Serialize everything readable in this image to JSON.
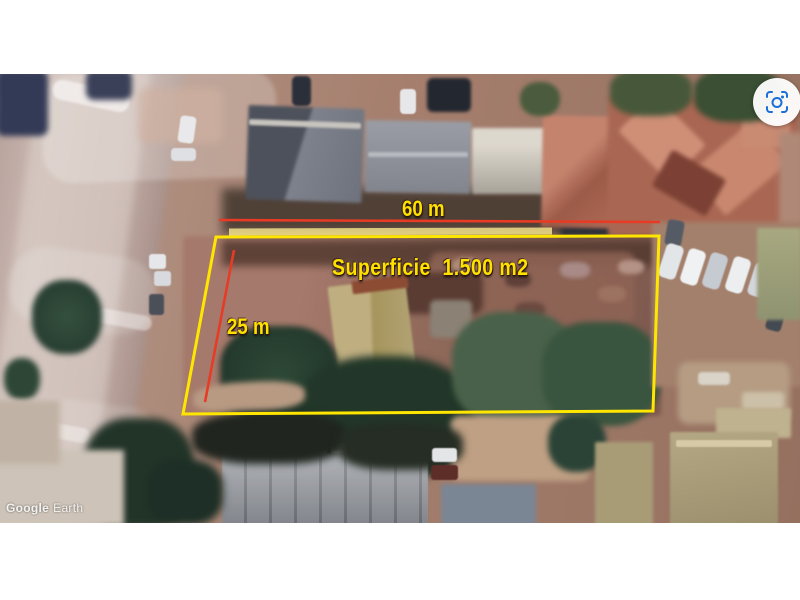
{
  "annotations": {
    "width_label": "60 m",
    "depth_label": "25 m",
    "area_label": "Superficie  1.500 m2",
    "measurement_line_color": "#e73b25",
    "boundary_color": "#ffe600",
    "label_color": "#ffe100"
  },
  "watermark": {
    "brand": "Google",
    "product": "Earth"
  },
  "controls": {
    "capture_button_icon": "screenshot-lens-icon",
    "capture_icon_color": "#1a6ed8"
  }
}
